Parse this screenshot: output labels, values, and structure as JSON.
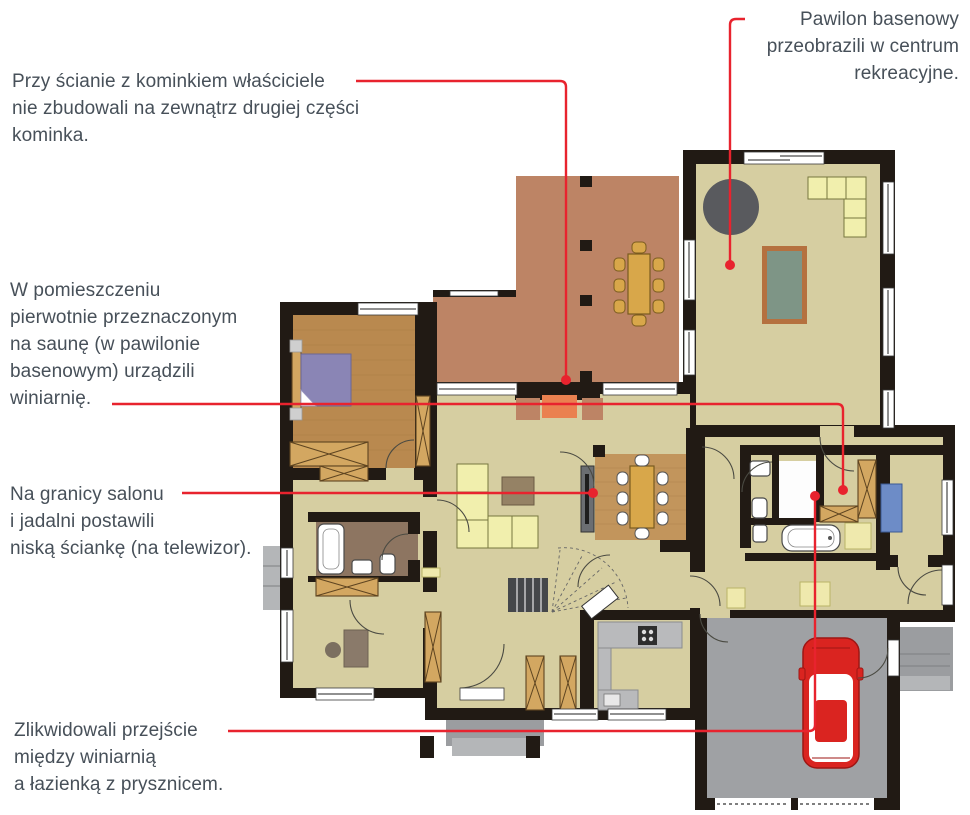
{
  "figure": {
    "kind": "annotated floor plan",
    "language": "Polish"
  },
  "annotations": {
    "fireplace": {
      "lines": [
        "Przy ścianie z kominkiem właściciele",
        "nie zbudowali na zewnątrz drugiej części",
        "kominka."
      ]
    },
    "pavilion": {
      "lines": [
        "Pawilon basenowy",
        "przeobrazili w centrum",
        "rekreacyjne."
      ]
    },
    "winery": {
      "lines": [
        "W pomieszczeniu",
        "pierwotnie przeznaczonym",
        "na saunę (w pawilonie",
        "basenowym) urządzili",
        "winiarnię."
      ]
    },
    "tv_wall": {
      "lines": [
        "Na granicy salonu",
        "i jadalni postawili",
        "niską ściankę (na telewizor)."
      ]
    },
    "passage": {
      "lines": [
        "Zlikwidowali przejście",
        "między winiarnią",
        "a łazienką z prysznicem."
      ]
    }
  },
  "colors": {
    "annotation_red": "#e8232e",
    "text": "#475059",
    "wall": "#211a14",
    "floor": "#d6cea1",
    "terrace": "#bd8465",
    "wood": "#b9894f",
    "garage": "#9fa1a4",
    "sofa": "#f1efad",
    "cabinet": "#d3a761",
    "bed": "#8a85b5",
    "pool": "#7e9586",
    "tub": "#595a5e",
    "fireplace": "#ea8150",
    "desk_blue": "#6d8cc7",
    "car": "#da2420"
  }
}
